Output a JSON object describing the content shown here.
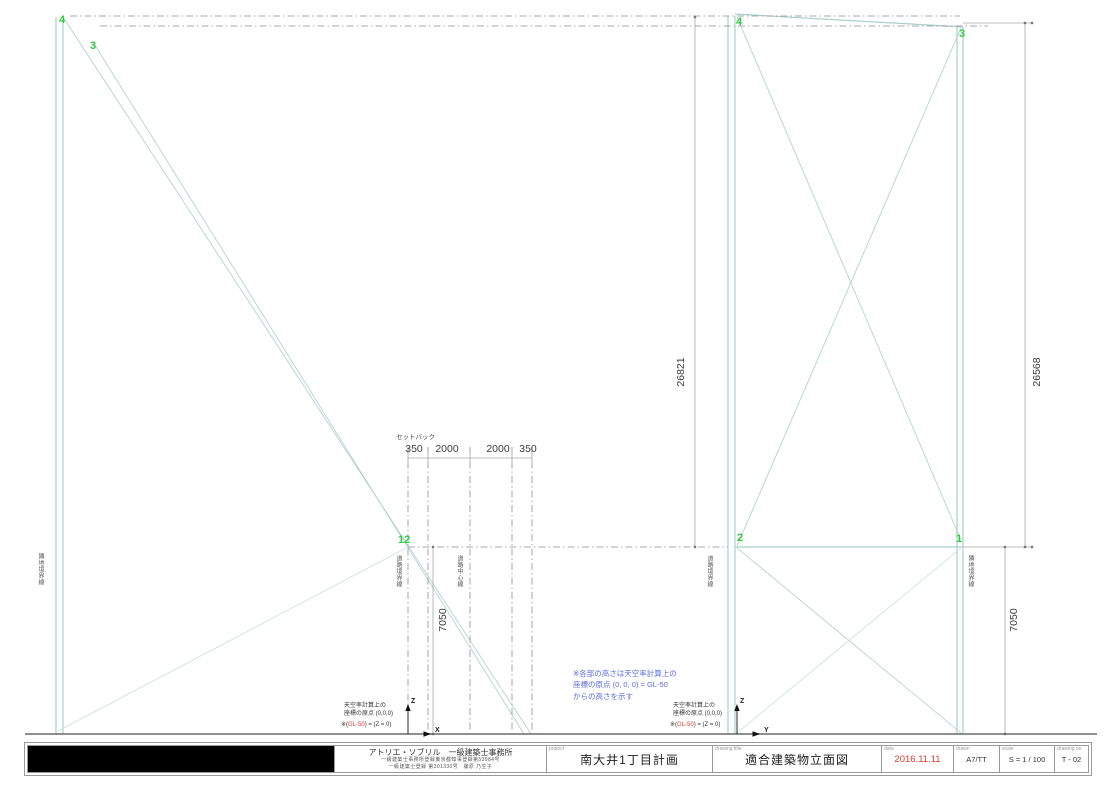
{
  "colors": {
    "building_line": "#a9d0c9",
    "building_line_light": "#c6dfda",
    "boundary_dash": "#8f8f8f",
    "dimension_line": "#a9a9a9",
    "ground_line": "#6a6a6a",
    "point_green": "#2ecc40",
    "accent_red": "#e0372e",
    "note_blue": "#5b6be0"
  },
  "drawing": {
    "points": {
      "p4_left": "4",
      "p3_left": "3",
      "p12": "12",
      "p4_right": "4",
      "p3_right": "3",
      "p2": "2",
      "p1": "1"
    },
    "dimensions": {
      "height_left": "26821",
      "height_right": "26568",
      "depth_left": "7050",
      "depth_right": "7050",
      "setback_label": "セットバック",
      "setback_values": [
        "350",
        "2000",
        "2000",
        "350"
      ]
    },
    "boundaries": {
      "neighbor_left": "隣地境界線",
      "road_left": "道路境界線",
      "road_center": "道路中心線",
      "road_right": "道路境界線",
      "neighbor_right": "隣地境界線"
    },
    "origin": {
      "line1": "天空率計算上の",
      "line2": "座標の原点 (0,0,0)",
      "note_prefix": "※(",
      "note_red": "GL-50",
      "note_suffix": ") = (Z = 0)",
      "axis_z": "Z",
      "axis_x": "X",
      "axis_y": "Y"
    },
    "blue_note": {
      "line1": "※各部の高さは天空率計算上の",
      "line2": "座標の原点 (0, 0, 0) = GL-50",
      "line3": "からの高さを示す"
    }
  },
  "titleblock": {
    "architect": {
      "name": "アトリエ・ソブリル　一級建築士事務所",
      "reg1": "一級建築士事務所登録東京都知事登録第53984号",
      "reg2": "一級建築士登録 第301330号　篠原 乃生子"
    },
    "project": {
      "label": "project",
      "value": "南大井1丁目計画"
    },
    "drawing_title": {
      "label": "drawing title",
      "value": "適合建築物立面図"
    },
    "date": {
      "label": "date",
      "value": "2016.11.11"
    },
    "drawn": {
      "label": "drawn",
      "value": "A7/TT"
    },
    "scale": {
      "label": "scale",
      "value": "S = 1 / 100"
    },
    "number": {
      "label": "drawing no",
      "value": "T - 02"
    }
  }
}
